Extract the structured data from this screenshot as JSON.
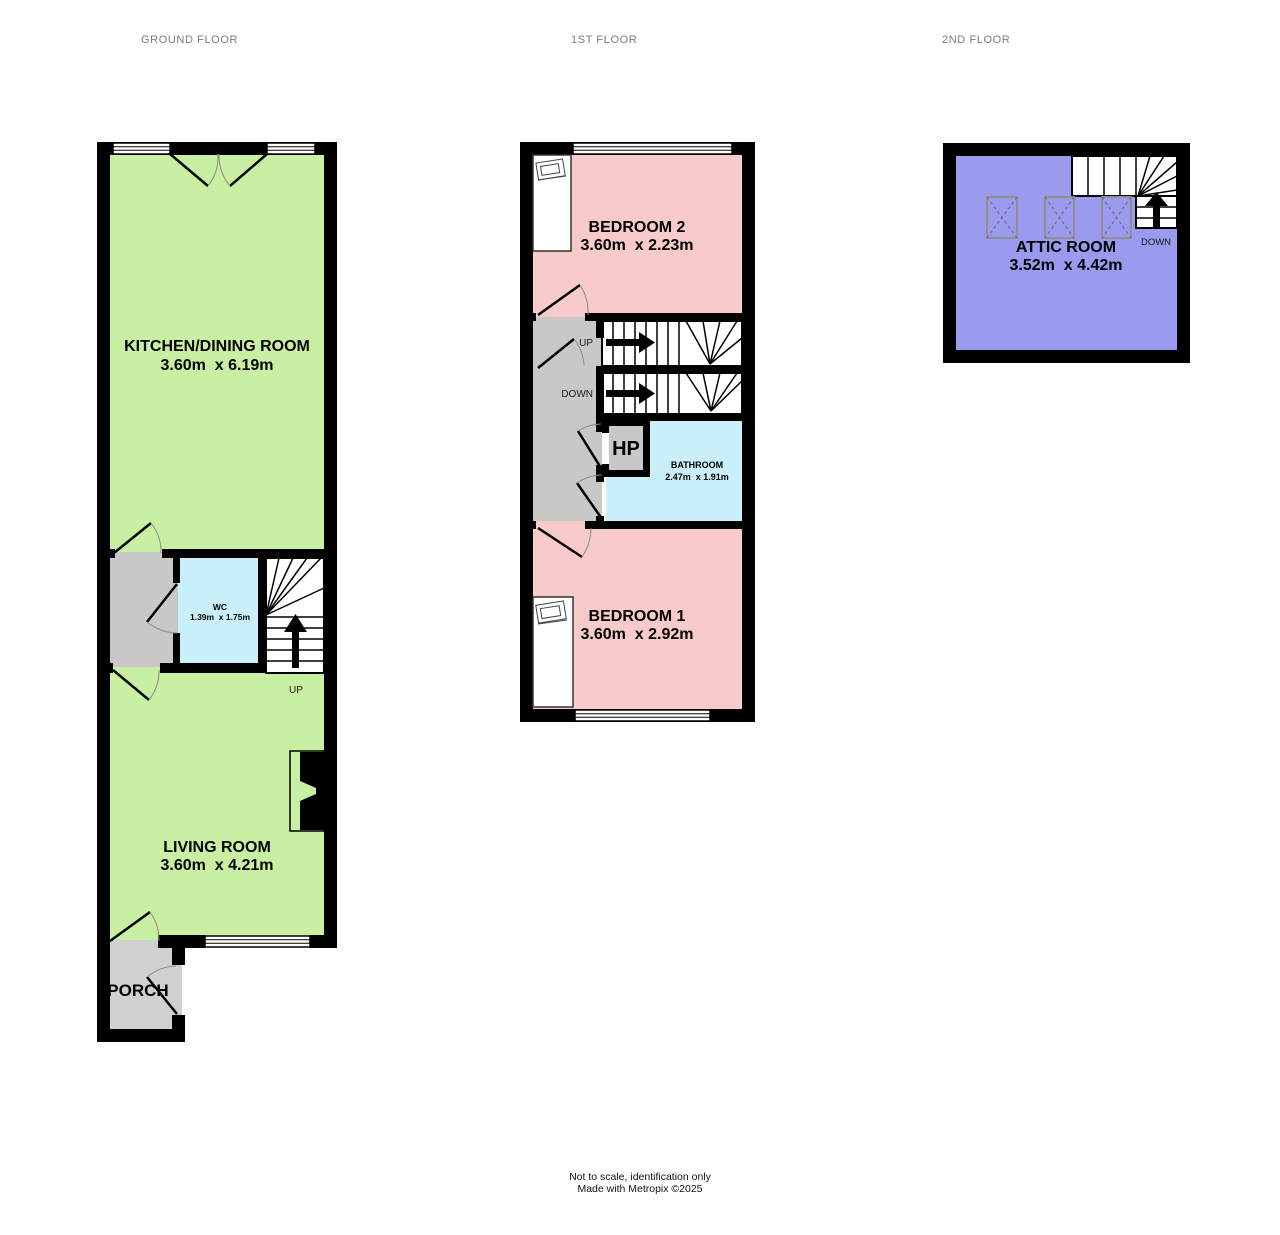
{
  "floors": {
    "ground": {
      "title": "GROUND FLOOR",
      "kitchen_name": "KITCHEN/DINING ROOM",
      "kitchen_dims": "3.60m  x 6.19m",
      "wc_name": "WC",
      "wc_dims": "1.39m  x 1.75m",
      "living_name": "LIVING ROOM",
      "living_dims": "3.60m  x 4.21m",
      "porch_name": "PORCH",
      "stairs_up": "UP"
    },
    "first": {
      "title": "1ST FLOOR",
      "bedroom2_name": "BEDROOM 2",
      "bedroom2_dims": "3.60m  x 2.23m",
      "stairs_up": "UP",
      "stairs_down": "DOWN",
      "hp_name": "HP",
      "bathroom_name": "BATHROOM",
      "bathroom_dims": "2.47m  x 1.91m",
      "bedroom1_name": "BEDROOM 1",
      "bedroom1_dims": "3.60m  x 2.92m"
    },
    "second": {
      "title": "2ND FLOOR",
      "attic_name": "ATTIC ROOM",
      "attic_dims": "3.52m  x 4.42m",
      "stairs_down": "DOWN"
    }
  },
  "footer": {
    "line1": "Not to scale, identification only",
    "line2": "Made with Metropix ©2025"
  },
  "colors": {
    "room_green": "#c9f0a2",
    "room_pink": "#f9caca",
    "room_cyan": "#c9f0fa",
    "room_purple": "#9a9aee",
    "hall_gray": "#c8c8c8",
    "porch_gray": "#d0d0d0",
    "wall_black": "#000000",
    "title_gray": "#7b7b7b"
  }
}
